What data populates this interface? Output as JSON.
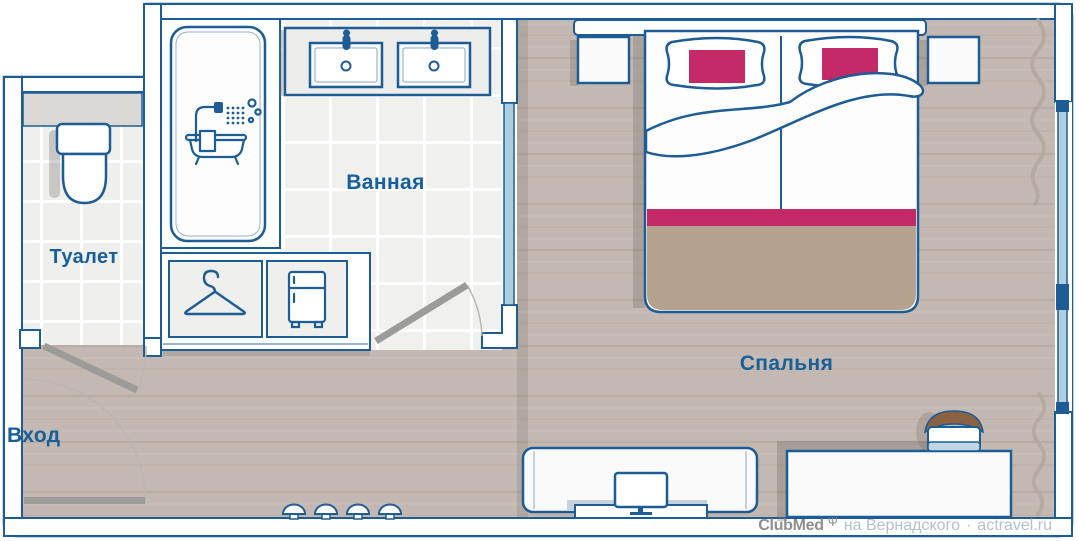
{
  "plan": {
    "type": "hotel-room-floor-plan",
    "rooms": [
      {
        "id": "toilet",
        "label": "Туалет"
      },
      {
        "id": "bathroom",
        "label": "Ванная"
      },
      {
        "id": "bedroom",
        "label": "Спальня"
      },
      {
        "id": "entrance",
        "label": "Вход"
      }
    ],
    "furniture": [
      "toilet",
      "bathtub-shower",
      "double-sink-vanity",
      "wardrobe-hanger",
      "minibar-fridge",
      "double-bed",
      "pillows",
      "nightstand-left",
      "nightstand-right",
      "headboard",
      "tv-console",
      "tv",
      "wall-hooks",
      "desk",
      "chair",
      "window",
      "curtains",
      "entry-door",
      "toilet-door",
      "bathroom-door"
    ],
    "colors": {
      "outline_blue": "#1d5c94",
      "label_blue": "#17609a",
      "accent_magenta": "#c52a68",
      "blanket_tan": "#b4a28e",
      "wood_floor": "#c4b9b2",
      "tile_floor": "#f0f0ee",
      "glass_blue": "#aecfdf",
      "door_gray": "#9b9b97",
      "chair_brown": "#8a6243"
    }
  },
  "watermark": {
    "brand": "ClubMed",
    "symbol": "Ψ",
    "location": "на Вернадского",
    "separator": "·",
    "site": "actravel.ru"
  }
}
